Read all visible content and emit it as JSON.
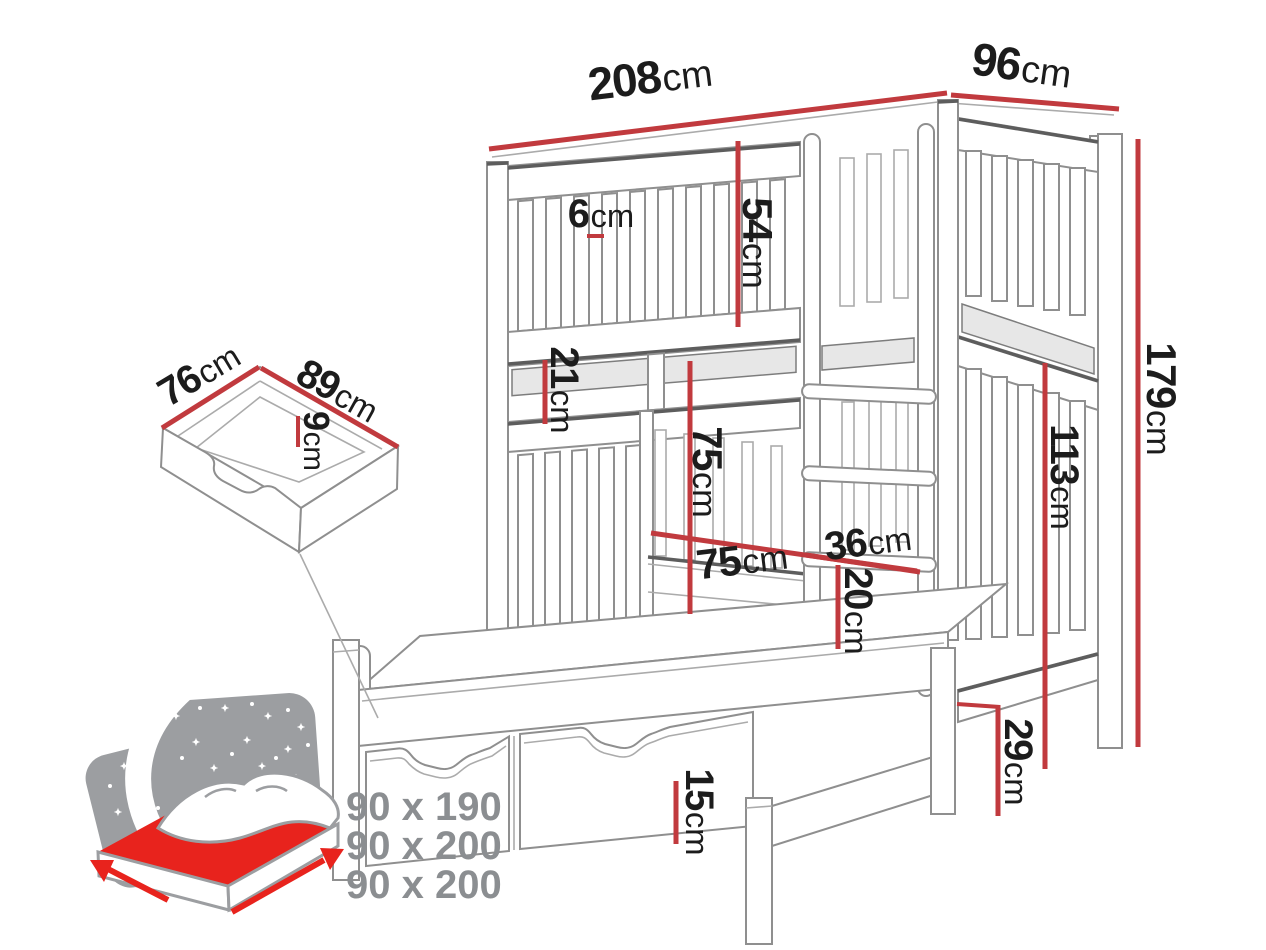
{
  "diagram": {
    "dims": {
      "width": {
        "value": "208",
        "unit": "cm"
      },
      "depth": {
        "value": "96",
        "unit": "cm"
      },
      "slat_gap": {
        "value": "6",
        "unit": "cm"
      },
      "top_guard_height": {
        "value": "54",
        "unit": "cm"
      },
      "bunk_gap": {
        "value": "21",
        "unit": "cm"
      },
      "middle_clearance": {
        "value": "75",
        "unit": "cm"
      },
      "entry_width": {
        "value": "75",
        "unit": "cm"
      },
      "ladder_width": {
        "value": "36",
        "unit": "cm"
      },
      "rung_spacing": {
        "value": "20",
        "unit": "cm"
      },
      "lower_section_height": {
        "value": "113",
        "unit": "cm"
      },
      "total_height": {
        "value": "179",
        "unit": "cm"
      },
      "underbed_clearance": {
        "value": "29",
        "unit": "cm"
      },
      "trundle_front_height": {
        "value": "15",
        "unit": "cm"
      },
      "drawer_depth": {
        "value": "76",
        "unit": "cm"
      },
      "drawer_width": {
        "value": "89",
        "unit": "cm"
      },
      "drawer_height": {
        "value": "9",
        "unit": "cm"
      }
    },
    "mattress_sizes": [
      "90 x 190",
      "90 x 200",
      "90 x 200"
    ],
    "colors": {
      "dimension_red": "#c13a3e",
      "mattress_red": "#e8231d",
      "line_gray": "#8f8f8f",
      "line_dark": "#5d5d5d",
      "text_black": "#1c1c1c",
      "sizes_gray": "#8b8e91"
    }
  }
}
